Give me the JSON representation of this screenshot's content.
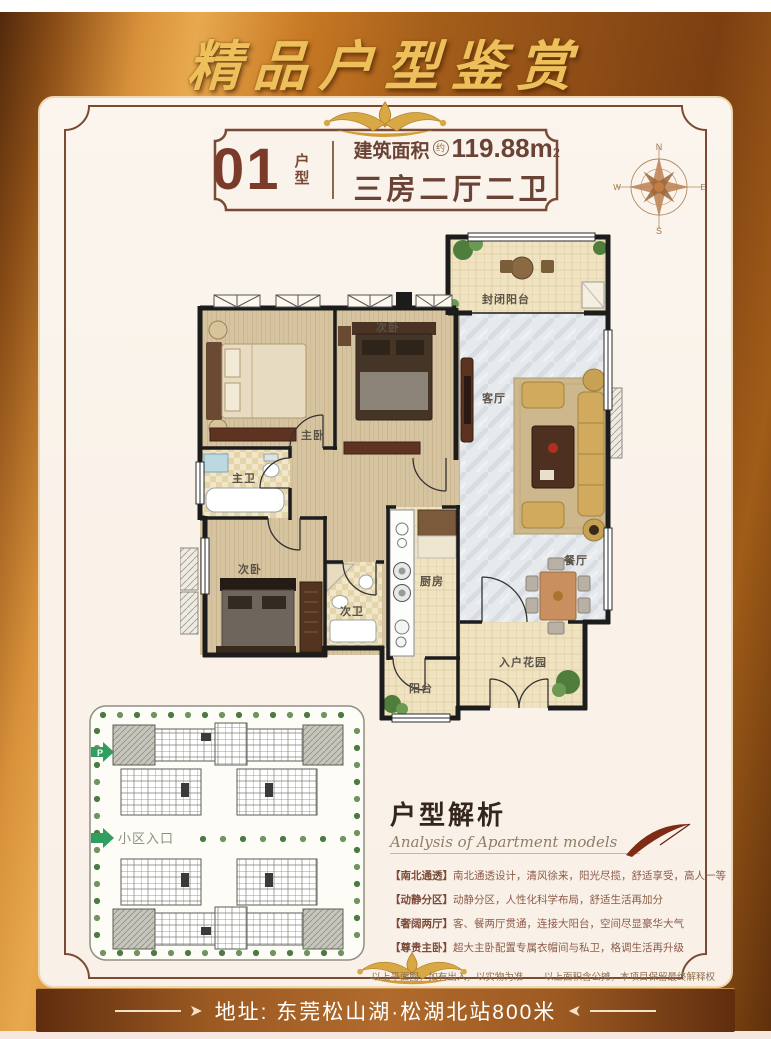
{
  "banner": {
    "title": "精品户型鉴赏"
  },
  "badge": {
    "number": "01",
    "number_label": "户型",
    "area_label": "建筑面积",
    "area_approx": "约",
    "area_value": "119.88m",
    "area_exponent": "2",
    "layout_text": "三房二厅二卫"
  },
  "compass": {
    "north": "N",
    "south": "S",
    "east": "E",
    "west": "W"
  },
  "floorplan": {
    "rooms": {
      "enclosed_balcony": "封闭阳台",
      "living_room": "客厅",
      "master_bedroom": "主卧",
      "bedroom2": "次卧",
      "bedroom3": "次卧",
      "master_bath": "主卫",
      "second_bath": "次卫",
      "kitchen": "厨房",
      "dining_room": "餐厅",
      "entry_garden": "入户花园",
      "balcony": "阳台"
    }
  },
  "siteplan": {
    "parking_label": "P",
    "entrance_label": "小区入口"
  },
  "analysis": {
    "title": "户型解析",
    "subtitle": "Analysis of Apartment models",
    "items": [
      {
        "tag": "【南北通透】",
        "text": "南北通透设计，清风徐来，阳光尽揽，舒适享受，高人一等"
      },
      {
        "tag": "【动静分区】",
        "text": "动静分区，人性化科学布局，舒适生活再加分"
      },
      {
        "tag": "【奢阔两厅】",
        "text": "客、餐两厅贯通，连接大阳台，空间尽显豪华大气"
      },
      {
        "tag": "【尊贵主卧】",
        "text": "超大主卧配置专属衣帽间与私卫，格调生活再升级"
      }
    ]
  },
  "disclaimer": {
    "part1": "以上平面图，如有出入，以实物为准",
    "part2": "以上面积含公摊，本项目保留最终解释权"
  },
  "address": {
    "text": "地址: 东莞松山湖·松湖北站800米"
  },
  "colors": {
    "frame_gold": "#c87a24",
    "banner_text": "#eec05c",
    "badge_text": "#6b4336",
    "entrance_green": "#2f9e5f",
    "analysis_text": "#8d5b49"
  }
}
